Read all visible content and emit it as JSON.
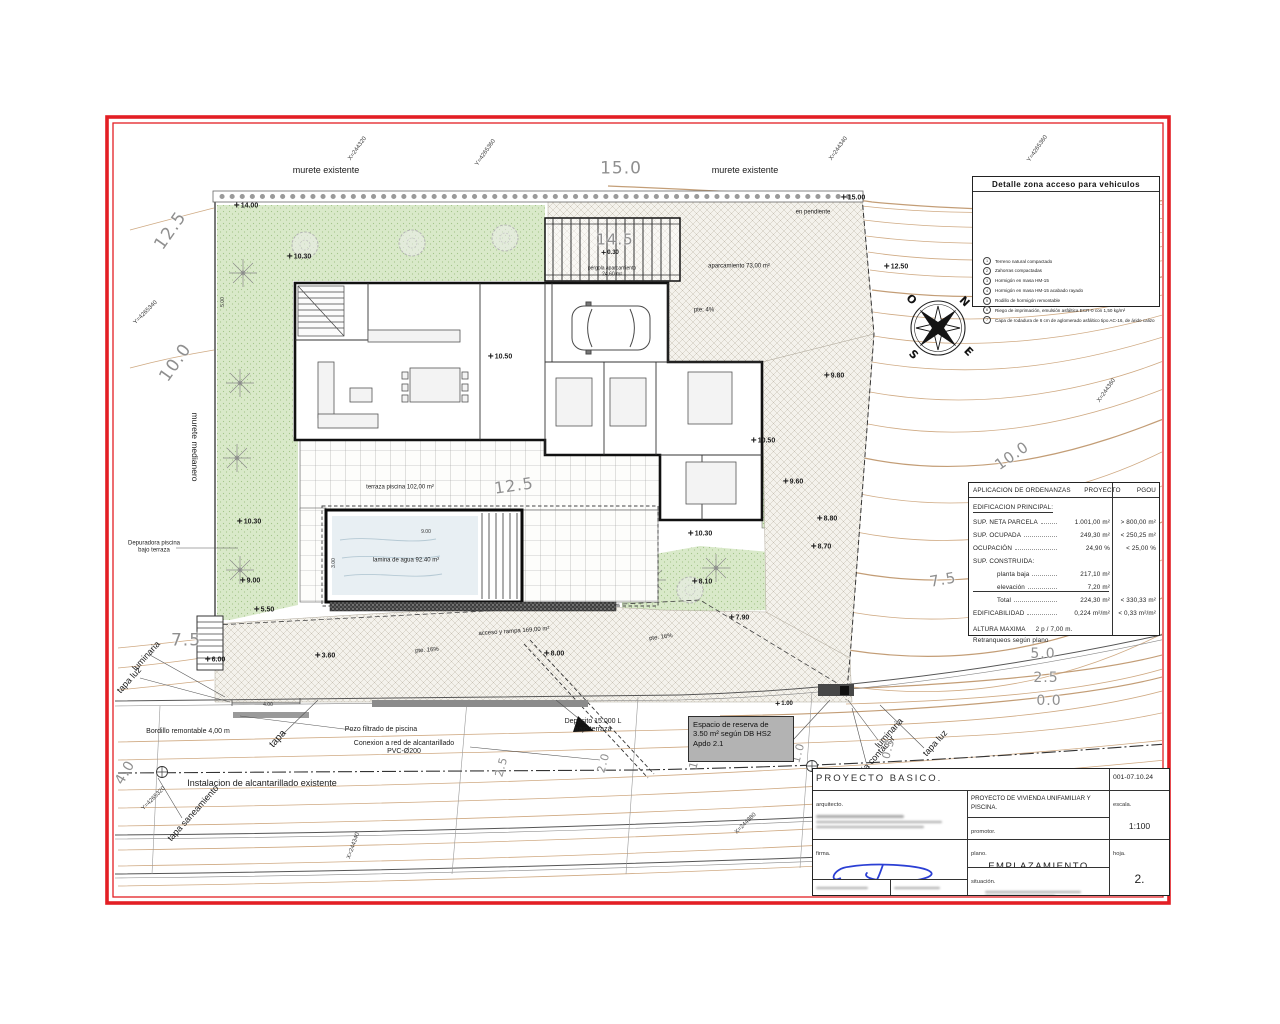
{
  "sheet": {
    "frame_color": "#e31e24",
    "contour_color": "#c79b6d",
    "grass_color": "#d9e9c9",
    "water_color": "#e8eff3",
    "signature_color": "#2b3fd4"
  },
  "compass": {
    "n": "N",
    "e": "E",
    "s": "S",
    "o": "O"
  },
  "detail_box": {
    "title": "Detalle zona acceso para vehiculos",
    "legend": [
      {
        "n": "1",
        "t": "Terreno natural compactado"
      },
      {
        "n": "2",
        "t": "Zahorras compactadas"
      },
      {
        "n": "3",
        "t": "Hormigón en masa HM-15"
      },
      {
        "n": "4",
        "t": "Hormigón en masa HM-15 acabado rayado"
      },
      {
        "n": "5",
        "t": "Rodillo de hormigón remontable"
      },
      {
        "n": "6",
        "t": "Riego de imprimación, emulsión asfáltica ECR-0 con 1,50 kg/m²"
      },
      {
        "n": "7",
        "t": "Capa de rodadura de 6 cm de aglomerado asfáltico tipo AC-16, de árido calizo"
      }
    ]
  },
  "ordinance_table": {
    "headers": [
      "APLICACION DE ORDENANZAS",
      "PROYECTO",
      "PGOU"
    ],
    "section": "EDIFICACION PRINCIPAL:",
    "rows": [
      {
        "label": "SUP. NETA PARCELA",
        "proyecto": "1.001,00 m²",
        "pgou": "> 800,00 m²"
      },
      {
        "label": "SUP. OCUPADA",
        "proyecto": "249,30 m²",
        "pgou": "< 250,25 m²"
      },
      {
        "label": "OCUPACIÓN",
        "proyecto": "24,90 %",
        "pgou": "< 25,00 %"
      }
    ],
    "sub_label": "SUP. CONSTRUIDA:",
    "subs": [
      {
        "label": "planta baja",
        "proyecto": "217,10 m²",
        "pgou": ""
      },
      {
        "label": "elevación",
        "proyecto": "7,20 m²",
        "pgou": ""
      },
      {
        "label": "Total",
        "proyecto": "224,30 m²",
        "pgou": "< 330,33 m²"
      }
    ],
    "edif": {
      "label": "EDIFICABILIDAD",
      "proyecto": "0,224 m²/m²",
      "pgou": "< 0,33 m²/m²"
    },
    "altura_label": "ALTURA MAXIMA",
    "altura_value": "2 p  / 7,00 m.",
    "retranqueos": "Retranqueos según plano"
  },
  "title_block": {
    "project_type": "PROYECTO  BASICO.",
    "date_code": "001-07.10.24",
    "arquitecto_label": "arquitecto.",
    "firma_label": "firma.",
    "project_title": "PROYECTO DE VIVIENDA UNIFAMILIAR Y PISCINA.",
    "promotor_label": "promotor.",
    "plano_label": "plano.",
    "plano_value": "EMPLAZAMIENTO",
    "situacion_label": "situación.",
    "escala_label": "escala.",
    "escala_value": "1:100",
    "hoja_label": "hoja.",
    "hoja_value": "2."
  },
  "reserve_note": {
    "text": "Espacio de reserva de\n3.50 m² según DB HS2\nApdo 2.1"
  },
  "plan": {
    "annotations": [
      {
        "t": "murete existente",
        "x": 326,
        "y": 170,
        "fs": 9
      },
      {
        "t": "murete existente",
        "x": 745,
        "y": 170,
        "fs": 9
      },
      {
        "t": "15.0",
        "x": 621,
        "y": 169,
        "cls": "c",
        "fs": 17
      },
      {
        "t": "X=244320",
        "x": 358,
        "y": 149,
        "cls": "o",
        "rot": -55
      },
      {
        "t": "Y=4265360",
        "x": 486,
        "y": 153,
        "cls": "o",
        "rot": -55
      },
      {
        "t": "X=244340",
        "x": 839,
        "y": 149,
        "cls": "o",
        "rot": -55
      },
      {
        "t": "Y=4265360",
        "x": 1038,
        "y": 149,
        "cls": "o",
        "rot": -55
      },
      {
        "t": "14.00",
        "x": 246,
        "y": 206,
        "cls": "s"
      },
      {
        "t": "15.00",
        "x": 853,
        "y": 198,
        "cls": "s"
      },
      {
        "t": "en pendiente",
        "x": 813,
        "y": 213,
        "fs": 6
      },
      {
        "t": "12.50",
        "x": 896,
        "y": 267,
        "cls": "s"
      },
      {
        "t": "12.5",
        "x": 171,
        "y": 231,
        "cls": "c",
        "fs": 17,
        "rot": -55
      },
      {
        "t": "10.30",
        "x": 299,
        "y": 257,
        "cls": "s"
      },
      {
        "t": "14.5",
        "x": 615,
        "y": 240,
        "cls": "c",
        "fs": 15
      },
      {
        "t": "0.30",
        "x": 610,
        "y": 253,
        "cls": "s",
        "fs": 6
      },
      {
        "t": "pérgola aparcamiento\n24,60 m²",
        "x": 612,
        "y": 272,
        "fs": 5
      },
      {
        "t": "aparcamiento 73,00 m²",
        "x": 739,
        "y": 267,
        "fs": 6
      },
      {
        "t": "pte: 4%",
        "x": 704,
        "y": 311,
        "fs": 6
      },
      {
        "t": "Y=4265340",
        "x": 146,
        "y": 313,
        "cls": "o",
        "rot": -45
      },
      {
        "t": "10.0",
        "x": 176,
        "y": 363,
        "cls": "c",
        "fs": 17,
        "rot": -55
      },
      {
        "t": "murete medianero",
        "x": 194,
        "y": 447,
        "fs": 8.5,
        "rot": 90
      },
      {
        "t": "10.50",
        "x": 500,
        "y": 357,
        "cls": "s"
      },
      {
        "t": "9.80",
        "x": 834,
        "y": 376,
        "cls": "s"
      },
      {
        "t": "X=244360",
        "x": 1107,
        "y": 391,
        "cls": "o",
        "rot": -55
      },
      {
        "t": "10.0",
        "x": 1012,
        "y": 456,
        "cls": "c",
        "fs": 15,
        "rot": -35
      },
      {
        "t": "10.50",
        "x": 763,
        "y": 441,
        "cls": "s"
      },
      {
        "t": "9.60",
        "x": 793,
        "y": 482,
        "cls": "s"
      },
      {
        "t": "12.5",
        "x": 514,
        "y": 486,
        "cls": "c",
        "fs": 16,
        "rot": -8
      },
      {
        "t": "terraza piscina 102,00 m²",
        "x": 400,
        "y": 488,
        "fs": 6
      },
      {
        "t": "8.80",
        "x": 827,
        "y": 519,
        "cls": "s"
      },
      {
        "t": "10.30",
        "x": 249,
        "y": 522,
        "cls": "s"
      },
      {
        "t": "10.30",
        "x": 700,
        "y": 534,
        "cls": "s"
      },
      {
        "t": "8.70",
        "x": 821,
        "y": 547,
        "cls": "s"
      },
      {
        "t": "Depuradora piscina\nbajo terraza",
        "x": 154,
        "y": 547,
        "fs": 6
      },
      {
        "t": "lamina de agua 92.40 m²",
        "x": 406,
        "y": 561,
        "fs": 6
      },
      {
        "t": "9.00",
        "x": 250,
        "y": 581,
        "cls": "s"
      },
      {
        "t": "8.10",
        "x": 702,
        "y": 582,
        "cls": "s"
      },
      {
        "t": "5.50",
        "x": 264,
        "y": 610,
        "cls": "s"
      },
      {
        "t": "7.90",
        "x": 739,
        "y": 618,
        "cls": "s"
      },
      {
        "t": "7.5",
        "x": 943,
        "y": 580,
        "cls": "c",
        "fs": 15,
        "rot": -10
      },
      {
        "t": "7.5",
        "x": 186,
        "y": 641,
        "cls": "c",
        "fs": 17
      },
      {
        "t": "6.00",
        "x": 215,
        "y": 660,
        "cls": "s"
      },
      {
        "t": "3.60",
        "x": 325,
        "y": 656,
        "cls": "s"
      },
      {
        "t": "8.00",
        "x": 554,
        "y": 654,
        "cls": "s"
      },
      {
        "t": "pte. 16%",
        "x": 427,
        "y": 651,
        "fs": 6,
        "rot": -4
      },
      {
        "t": "pte. 16%",
        "x": 661,
        "y": 638,
        "fs": 6,
        "rot": -8
      },
      {
        "t": "acceso y rampa 169,00 m²",
        "x": 514,
        "y": 632,
        "fs": 6,
        "rot": -4
      },
      {
        "t": "luminaria",
        "x": 146,
        "y": 656,
        "fs": 9,
        "rot": -48
      },
      {
        "t": "tapa luz",
        "x": 129,
        "y": 680,
        "fs": 9,
        "rot": -48
      },
      {
        "t": "5.0",
        "x": 1043,
        "y": 655,
        "cls": "c",
        "fs": 14
      },
      {
        "t": "2.5",
        "x": 1046,
        "y": 679,
        "cls": "c",
        "fs": 14
      },
      {
        "t": "0.0",
        "x": 1049,
        "y": 702,
        "cls": "c",
        "fs": 14
      },
      {
        "t": "1.00",
        "x": 784,
        "y": 704,
        "cls": "s",
        "fs": 6
      },
      {
        "t": "4.00",
        "x": 268,
        "y": 706,
        "cls": "d"
      },
      {
        "t": "Bordillo remontable 4,00 m",
        "x": 188,
        "y": 732,
        "fs": 7
      },
      {
        "t": "tapa",
        "x": 278,
        "y": 739,
        "fs": 10,
        "rot": -48
      },
      {
        "t": "Pozo filtrado de piscina",
        "x": 381,
        "y": 730,
        "fs": 7
      },
      {
        "t": "Conexion a red de alcantarillado\nPVC-Ø200",
        "x": 404,
        "y": 748,
        "fs": 7
      },
      {
        "t": "Deposito 15.000 L\nbajo terraza",
        "x": 593,
        "y": 726,
        "fs": 7
      },
      {
        "t": "luminaria",
        "x": 889,
        "y": 733,
        "fs": 9,
        "rot": -48
      },
      {
        "t": "caja contador",
        "x": 875,
        "y": 757,
        "fs": 9,
        "rot": -48
      },
      {
        "t": "tapa luz",
        "x": 935,
        "y": 743,
        "fs": 9,
        "rot": -48
      },
      {
        "t": "Instalacion de alcantarillado existente",
        "x": 262,
        "y": 783,
        "fs": 9
      },
      {
        "t": "tapa saneamiento",
        "x": 193,
        "y": 813,
        "fs": 9,
        "rot": -48
      },
      {
        "t": "4.0",
        "x": 126,
        "y": 773,
        "cls": "c",
        "fs": 14,
        "rot": -60
      },
      {
        "t": "2.5",
        "x": 502,
        "y": 767,
        "cls": "c",
        "fs": 11,
        "rot": -75
      },
      {
        "t": "2.0",
        "x": 604,
        "y": 763,
        "cls": "c",
        "fs": 11,
        "rot": -75
      },
      {
        "t": "1.5",
        "x": 696,
        "y": 759,
        "cls": "c",
        "fs": 11,
        "rot": -75
      },
      {
        "t": "1.0",
        "x": 799,
        "y": 753,
        "cls": "c",
        "fs": 11,
        "rot": -75
      },
      {
        "t": "0.5",
        "x": 889,
        "y": 749,
        "cls": "c",
        "fs": 11,
        "rot": -75
      },
      {
        "t": "Y=4265320",
        "x": 154,
        "y": 799,
        "cls": "o",
        "rot": -45
      },
      {
        "t": "X=244340",
        "x": 354,
        "y": 846,
        "cls": "o",
        "rot": -70
      },
      {
        "t": "X=244380",
        "x": 746,
        "y": 824,
        "cls": "o",
        "rot": -45
      },
      {
        "t": "9.00",
        "x": 426,
        "y": 533,
        "cls": "d"
      },
      {
        "t": "3.00",
        "x": 335,
        "y": 563,
        "cls": "d",
        "rot": -90
      },
      {
        "t": "5.00",
        "x": 224,
        "y": 302,
        "cls": "d",
        "rot": -90
      }
    ]
  }
}
